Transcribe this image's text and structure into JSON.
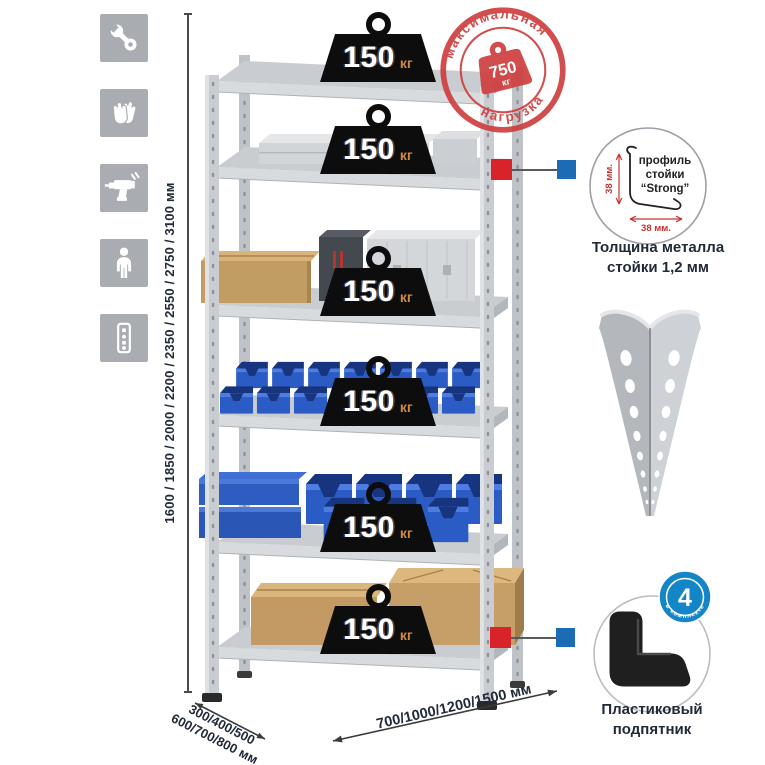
{
  "stamp": {
    "arc_top": "максимальная",
    "arc_bottom": "нагрузка",
    "value": "750",
    "unit": "кг"
  },
  "feature_icons": [
    "wrench",
    "gloves",
    "drill",
    "person",
    "rack-post"
  ],
  "dimensions": {
    "height": "1600 / 1850 / 2000 / 2200 / 2350 / 2550 / 2750 / 3100 мм",
    "depth_line1": "300/400/500",
    "depth_line2": "600/700/800 мм",
    "width": "700/1000/1200/1500 мм"
  },
  "shelf_loads": [
    {
      "value": "150",
      "unit": "кг"
    },
    {
      "value": "150",
      "unit": "кг"
    },
    {
      "value": "150",
      "unit": "кг"
    },
    {
      "value": "150",
      "unit": "кг"
    },
    {
      "value": "150",
      "unit": "кг"
    },
    {
      "value": "150",
      "unit": "кг"
    }
  ],
  "profile_detail": {
    "label_line1": "профиль",
    "label_line2": "стойки",
    "label_line3": "“Strong”",
    "dim_v": "38 мм.",
    "dim_h": "38 мм.",
    "caption_line1": "Толщина металла",
    "caption_line2": "стойки 1,2 мм"
  },
  "foot_detail": {
    "badge_value": "4",
    "badge_arc": "в комплекте",
    "caption_line1": "Пластиковый",
    "caption_line2": "подпятник"
  },
  "colors": {
    "accent_red": "#d23b3b",
    "accent_blue": "#1486c8",
    "bin_blue": "#2b5cc5",
    "metal_gray": "#c9ccd0",
    "text_dark": "#212a38"
  }
}
